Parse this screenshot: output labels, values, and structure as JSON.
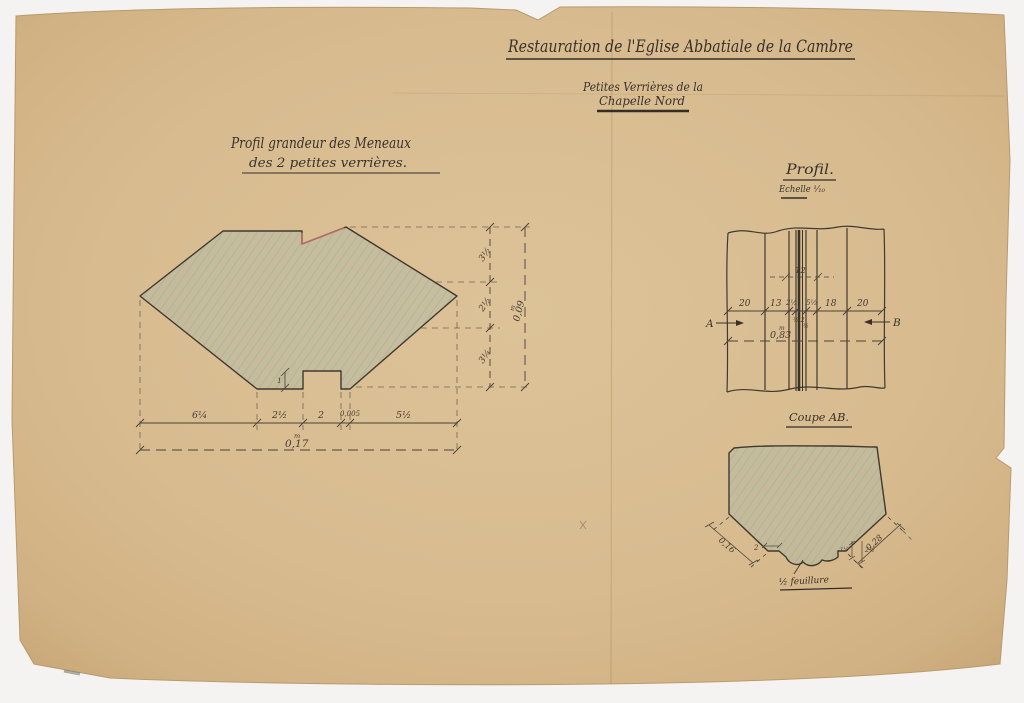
{
  "document": {
    "title": "Restauration de l'Eglise Abbatiale de la Cambre",
    "subtitle": "Petites Verrières de la",
    "subtitle_line2": "Chapelle Nord"
  },
  "left_drawing": {
    "caption_line1": "Profil grandeur des Meneaux",
    "caption_line2": "des 2 petites verrières.",
    "notch_depth": "1",
    "vertical_dims": [
      "3½",
      "2½",
      "3¼"
    ],
    "vertical_total": "0,09",
    "vertical_total_unit": "m",
    "bottom_dims": [
      "6¼",
      "2½",
      "2",
      "0,005",
      "5½"
    ],
    "bottom_total": "0,17",
    "bottom_total_unit": "m"
  },
  "profile_drawing": {
    "caption": "Profil.",
    "scale": "Echelle ¹⁄₁₀",
    "top_dim": "12",
    "width_dims": [
      "20",
      "13",
      "2½",
      "5½",
      "18",
      "20"
    ],
    "center_dims": [
      "½,2",
      "½"
    ],
    "total": "0,83",
    "total_unit": "m",
    "section_marker_left": "A",
    "section_marker_right": "B"
  },
  "section_drawing": {
    "caption": "Coupe AB.",
    "left_slant_dim": "0,16",
    "right_slant_dim": "0,28",
    "small_dims": [
      "2",
      "1¼",
      "2½"
    ],
    "annotation": "½ feuillure"
  }
}
